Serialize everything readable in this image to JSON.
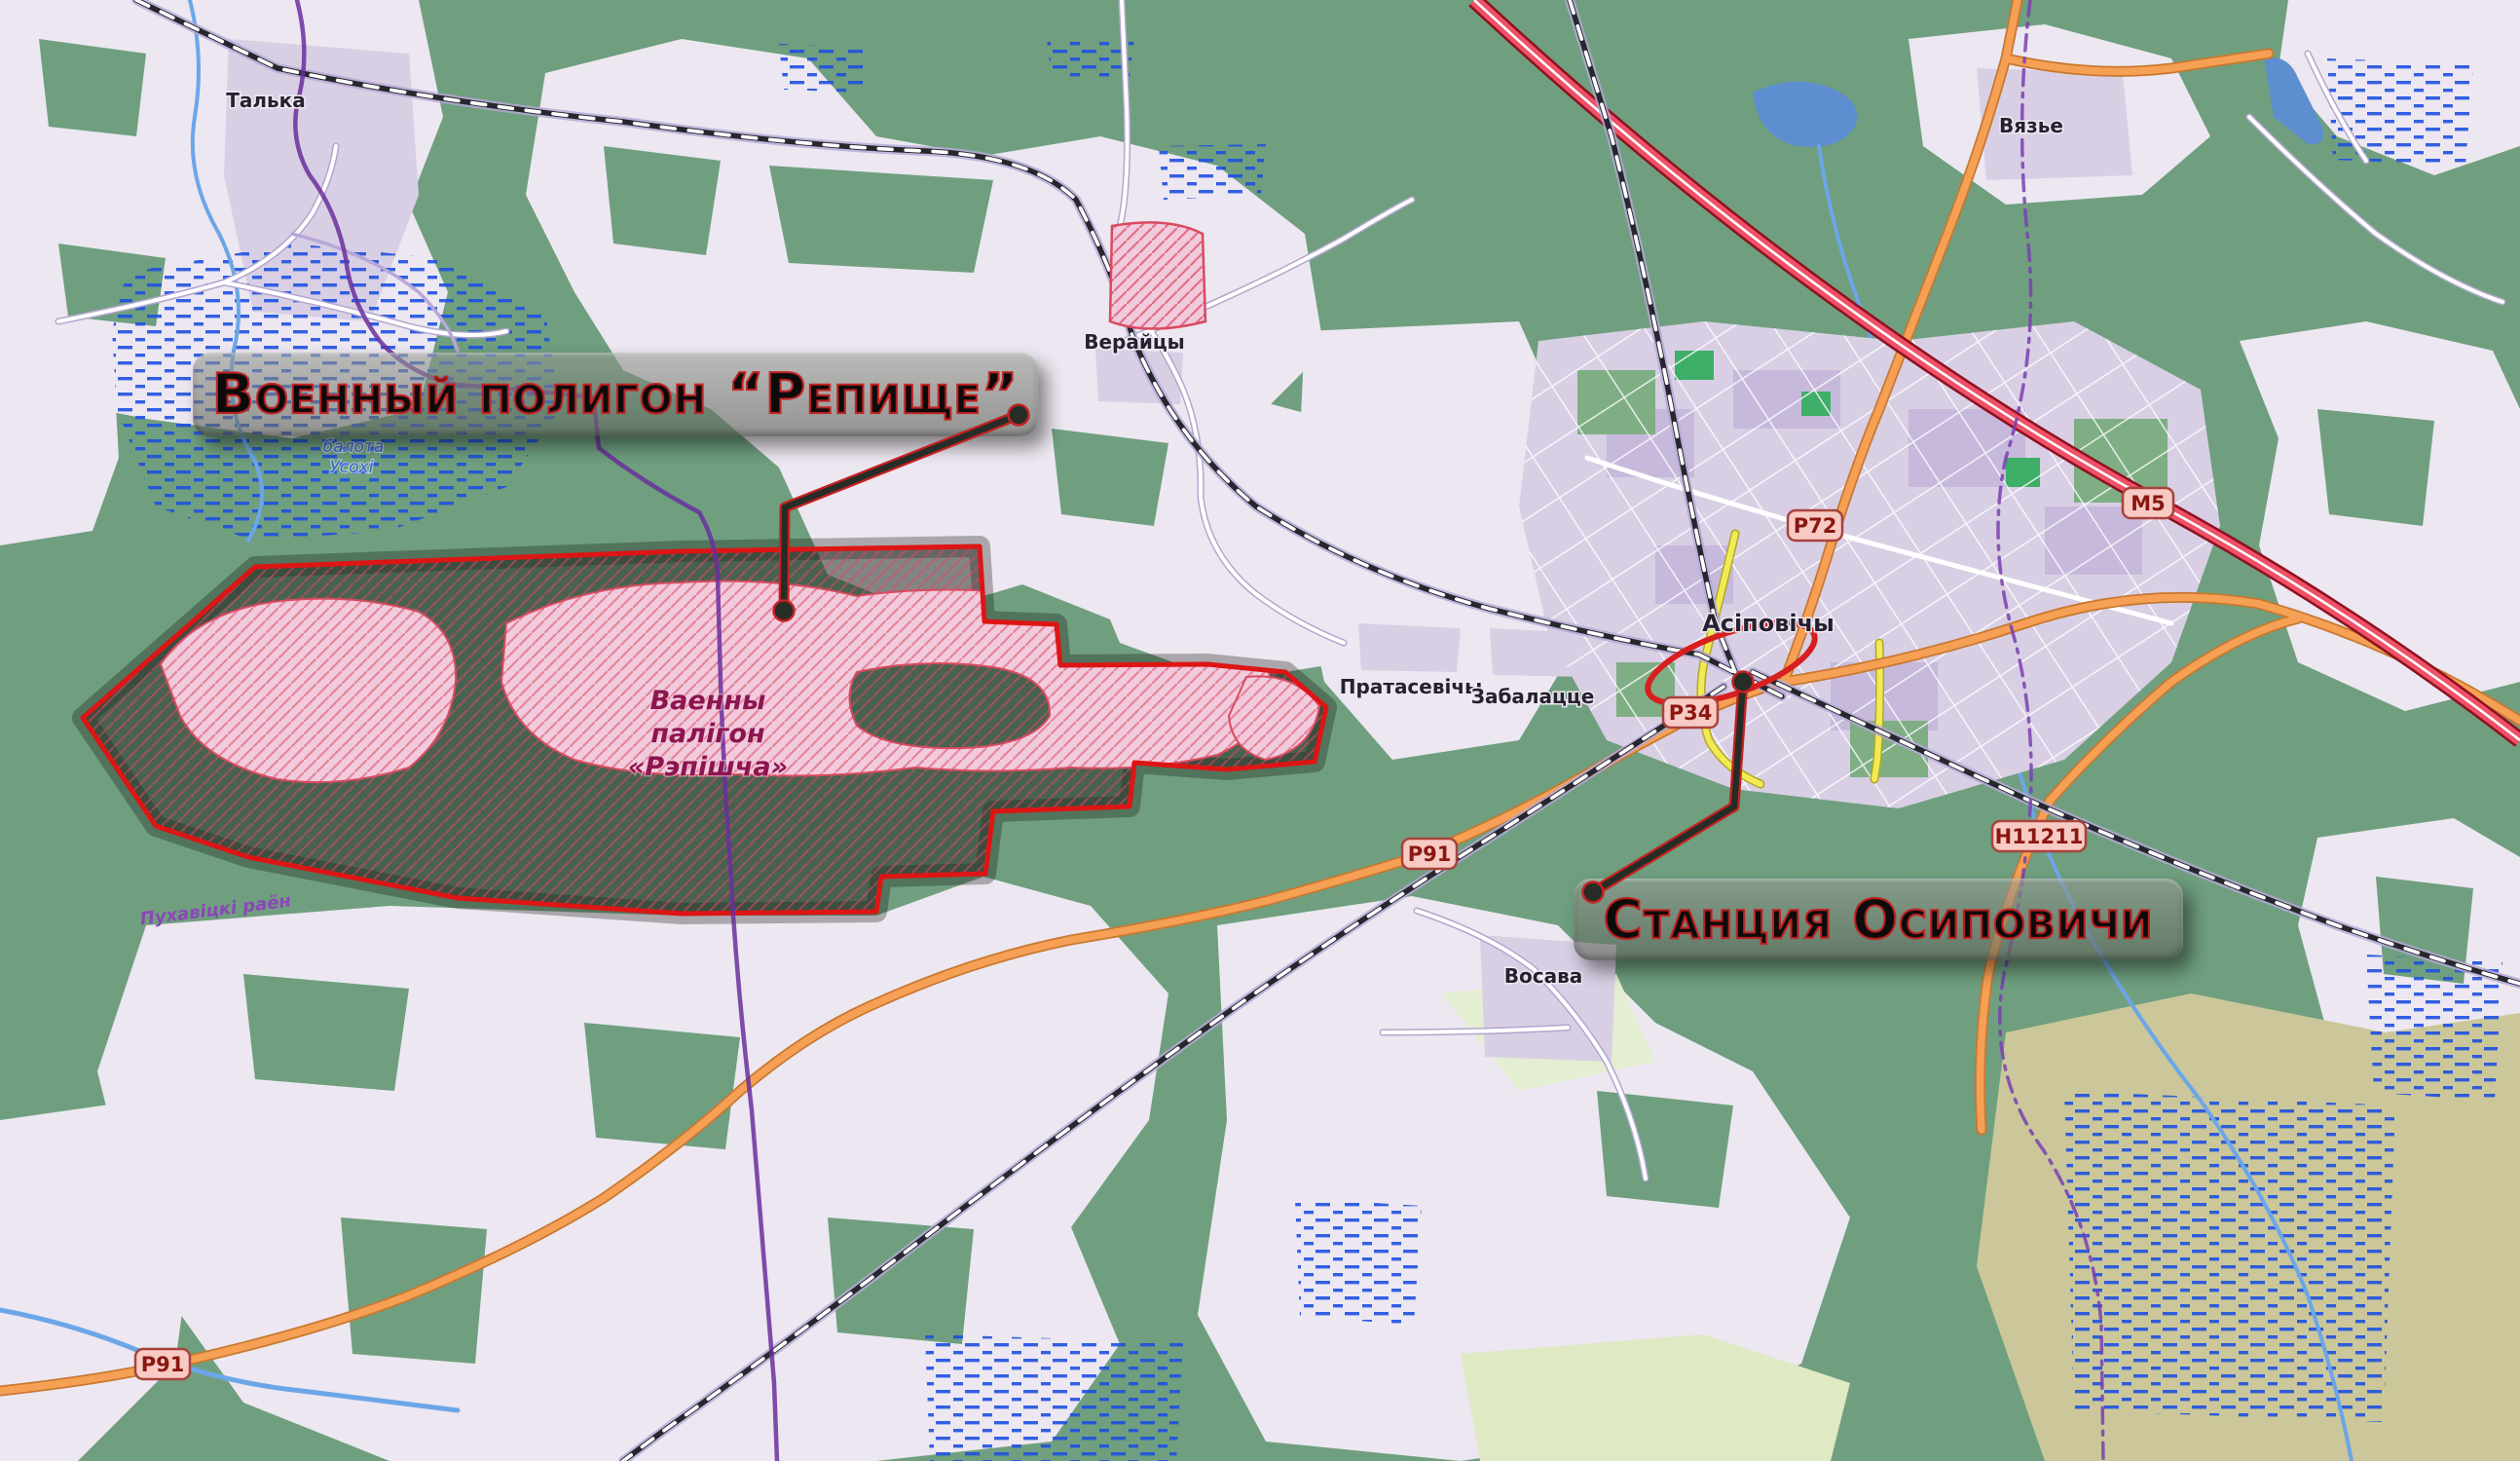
{
  "annotations": {
    "polygon_label": "Военный полигон “Репище”",
    "station_label": "Станция Осиповичи"
  },
  "places": {
    "talka": "Талька",
    "verajcy": "Верайцы",
    "vyazye": "Вязье",
    "asipovichy": "Асіповічы",
    "pratasevichy": "Пратасевічы",
    "zabalacce": "Забалацце",
    "vosava": "Восава"
  },
  "nature": {
    "marsh_name_line1": "балота",
    "marsh_name_line2": "Усохі"
  },
  "military_area": {
    "name_line1": "Ваенны",
    "name_line2": "палігон",
    "name_line3": "«Рэпішча»"
  },
  "admin": {
    "district": "Пухавіцкі раён"
  },
  "road_shields": {
    "m5": "М5",
    "p72": "Р72",
    "p34": "Р34",
    "p91_east": "Р91",
    "p91_southwest": "Р91",
    "h11211": "Н11211"
  },
  "colors": {
    "forest_green": "#6f9f7f",
    "open_land": "#ece7f0",
    "urban_lavender": "#d8cfe4",
    "military_pink": "#f2cadd",
    "area_border_red": "#dd1515",
    "marsh_blue": "#1e50e0",
    "water_blue": "#5d8fd0",
    "motorway_red": "#e8495f",
    "primary_orange": "#f5a054",
    "secondary_yellow": "#f2ea55",
    "boundary_purple": "#6a2f9c",
    "annotation_outline_red": "#c41f1f",
    "shield_fill": "#f8cac4",
    "shield_text": "#8a1710"
  }
}
